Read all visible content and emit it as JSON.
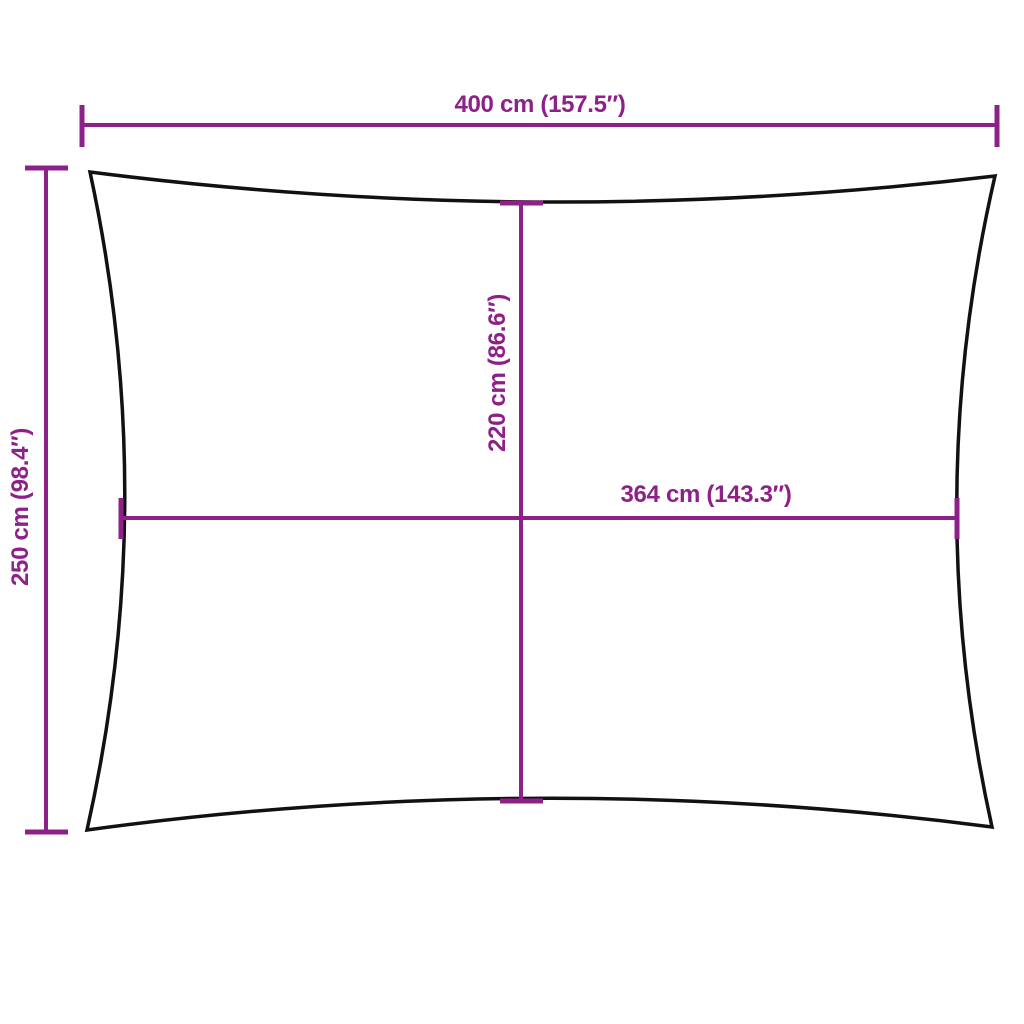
{
  "colors": {
    "dimension": "#8e2189",
    "outline": "#111111",
    "background": "#ffffff"
  },
  "labels": {
    "outer_width": "400 cm (157.5″)",
    "outer_height": "250 cm (98.4″)",
    "inner_height": "220 cm (86.6″)",
    "inner_width": "364 cm (143.3″)"
  }
}
